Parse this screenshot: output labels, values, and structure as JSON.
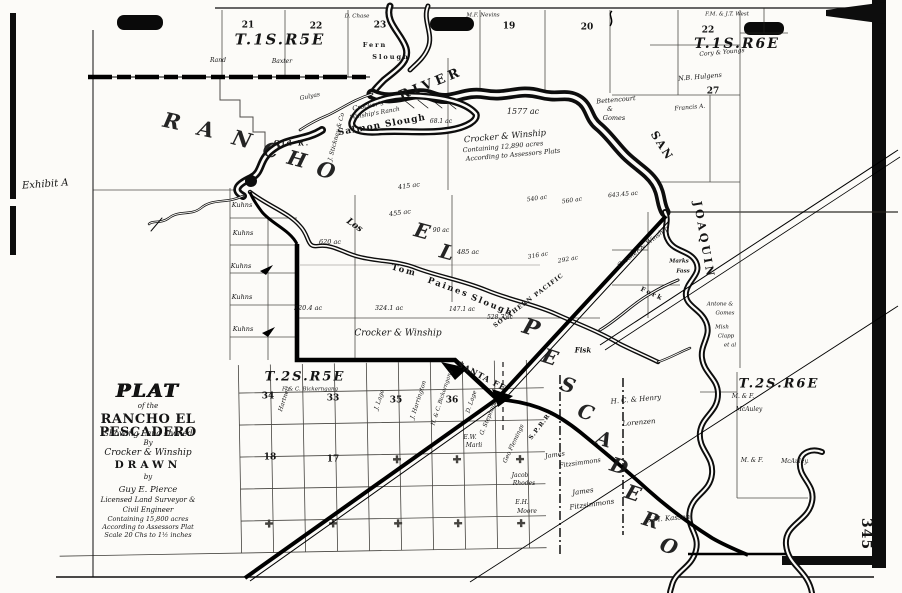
{
  "document": {
    "exhibit_label": "Exhibit A",
    "page_number": "345"
  },
  "title_block": {
    "lines": [
      "PLAT",
      "of the",
      "RANCHO EL PESCADERO",
      "Showing Land Owned",
      "By",
      "Crocker & Winship",
      "DRAWN",
      "by",
      "Guy E. Pierce",
      "Licensed Land Surveyor &",
      "Civil Engineer",
      "Containing 15,800 acres",
      "According to Assessors Plat",
      "Scale 20 Chs to 1½ inches"
    ]
  },
  "map": {
    "township_labels": [
      {
        "t": "T.1S.R5E",
        "x": 280,
        "y": 40,
        "r": 0,
        "s": 15
      },
      {
        "t": "T.1S.R6E",
        "x": 737,
        "y": 44,
        "r": 0,
        "s": 14
      },
      {
        "t": "T.2S.R5E",
        "x": 305,
        "y": 377,
        "r": 0,
        "s": 13
      },
      {
        "t": "T.2S.R6E",
        "x": 779,
        "y": 384,
        "r": 0,
        "s": 13
      }
    ],
    "section_numbers": [
      {
        "t": "21",
        "x": 248,
        "y": 26,
        "r": 0,
        "s": 9
      },
      {
        "t": "22",
        "x": 316,
        "y": 27,
        "r": 0,
        "s": 9
      },
      {
        "t": "23",
        "x": 380,
        "y": 26,
        "r": 0,
        "s": 9
      },
      {
        "t": "19",
        "x": 509,
        "y": 27,
        "r": 0,
        "s": 9
      },
      {
        "t": "20",
        "x": 587,
        "y": 28,
        "r": 0,
        "s": 9
      },
      {
        "t": "22",
        "x": 708,
        "y": 31,
        "r": 0,
        "s": 9
      },
      {
        "t": "27",
        "x": 713,
        "y": 92,
        "r": 0,
        "s": 9
      },
      {
        "t": "34",
        "x": 268,
        "y": 397,
        "r": 0,
        "s": 9
      },
      {
        "t": "33",
        "x": 333,
        "y": 399,
        "r": 0,
        "s": 9
      },
      {
        "t": "35",
        "x": 396,
        "y": 401,
        "r": 0,
        "s": 9
      },
      {
        "t": "36",
        "x": 452,
        "y": 401,
        "r": 0,
        "s": 9
      },
      {
        "t": "18",
        "x": 270,
        "y": 458,
        "r": 0,
        "s": 9
      },
      {
        "t": "17",
        "x": 333,
        "y": 460,
        "r": 0,
        "s": 9
      }
    ],
    "rancho_name_letters": [
      {
        "t": "R",
        "x": 172,
        "y": 121,
        "r": 12,
        "s": 21
      },
      {
        "t": "A",
        "x": 206,
        "y": 129,
        "r": 12,
        "s": 21
      },
      {
        "t": "N",
        "x": 242,
        "y": 139,
        "r": 15,
        "s": 21
      },
      {
        "t": "C",
        "x": 271,
        "y": 150,
        "r": 15,
        "s": 20
      },
      {
        "t": "H",
        "x": 297,
        "y": 159,
        "r": 15,
        "s": 20
      },
      {
        "t": "O",
        "x": 326,
        "y": 170,
        "r": 15,
        "s": 21
      },
      {
        "t": "E",
        "x": 422,
        "y": 231,
        "r": 15,
        "s": 20
      },
      {
        "t": "L",
        "x": 447,
        "y": 252,
        "r": 15,
        "s": 20
      },
      {
        "t": "P",
        "x": 531,
        "y": 328,
        "r": 18,
        "s": 22
      },
      {
        "t": "E",
        "x": 550,
        "y": 357,
        "r": 18,
        "s": 20
      },
      {
        "t": "S",
        "x": 568,
        "y": 385,
        "r": 18,
        "s": 20
      },
      {
        "t": "C",
        "x": 586,
        "y": 412,
        "r": 18,
        "s": 20
      },
      {
        "t": "A",
        "x": 604,
        "y": 439,
        "r": 18,
        "s": 20
      },
      {
        "t": "D",
        "x": 619,
        "y": 466,
        "r": 18,
        "s": 20
      },
      {
        "t": "E",
        "x": 633,
        "y": 493,
        "r": 18,
        "s": 20
      },
      {
        "t": "R",
        "x": 651,
        "y": 520,
        "r": 18,
        "s": 20
      },
      {
        "t": "O",
        "x": 669,
        "y": 546,
        "r": 18,
        "s": 20
      }
    ],
    "water_labels": [
      {
        "t": "RIVER",
        "x": 431,
        "y": 84,
        "r": -22,
        "s": 13,
        "ls": 4
      },
      {
        "t": "SAN",
        "x": 662,
        "y": 146,
        "r": 58,
        "s": 11,
        "ls": 2
      },
      {
        "t": "JOAQUIN",
        "x": 704,
        "y": 240,
        "r": 80,
        "s": 11,
        "ls": 3
      },
      {
        "t": "Salmon Slough",
        "x": 382,
        "y": 126,
        "r": -10,
        "s": 9,
        "ls": 1
      },
      {
        "t": "Tom",
        "x": 404,
        "y": 271,
        "r": 15,
        "s": 8.5
      },
      {
        "t": "Paines",
        "x": 448,
        "y": 288,
        "r": 20,
        "s": 8.5
      },
      {
        "t": "Slough",
        "x": 492,
        "y": 306,
        "r": 22,
        "s": 8.5
      },
      {
        "t": "Old R.",
        "x": 292,
        "y": 143,
        "r": 0,
        "s": 7
      },
      {
        "t": "Fern",
        "x": 375,
        "y": 45,
        "r": 0,
        "s": 6.5
      },
      {
        "t": "Slough",
        "x": 391,
        "y": 57,
        "r": 0,
        "s": 6.5
      },
      {
        "t": "Fork",
        "x": 652,
        "y": 294,
        "r": 25,
        "s": 6.5
      }
    ],
    "place_labels": [
      {
        "t": "Los",
        "x": 354,
        "y": 226,
        "r": 35,
        "s": 9
      },
      {
        "t": "Fisk",
        "x": 583,
        "y": 350,
        "r": 0,
        "s": 7
      },
      {
        "t": "Marks",
        "x": 679,
        "y": 262,
        "r": 0,
        "s": 5.5
      },
      {
        "t": "Fass",
        "x": 683,
        "y": 272,
        "r": 0,
        "s": 5.5
      }
    ],
    "railroad_labels": [
      {
        "t": "SOUTHERN PACIFIC",
        "x": 529,
        "y": 301,
        "r": -37,
        "s": 6,
        "ls": 1
      },
      {
        "t": "S.P.R.R.",
        "x": 541,
        "y": 426,
        "r": -52,
        "s": 6
      },
      {
        "t": "SANTA FE",
        "x": 482,
        "y": 376,
        "r": 28,
        "s": 8,
        "ls": 1
      }
    ],
    "owner_labels": [
      {
        "t": "Crocker & Winship",
        "x": 505,
        "y": 137,
        "r": -5,
        "s": 8.5
      },
      {
        "t": "Containing 12,890 acres",
        "x": 503,
        "y": 147,
        "r": -5,
        "s": 6.5
      },
      {
        "t": "According to Assessors Plats",
        "x": 513,
        "y": 155,
        "r": -5,
        "s": 6.5
      },
      {
        "t": "Crocker's",
        "x": 368,
        "y": 106,
        "r": -10,
        "s": 6.5
      },
      {
        "t": "Winship's Ranch",
        "x": 375,
        "y": 114,
        "r": -10,
        "s": 6
      },
      {
        "t": "Crocker & Winship",
        "x": 398,
        "y": 334,
        "r": 0,
        "s": 9
      },
      {
        "t": "Crocker & Winship",
        "x": 643,
        "y": 247,
        "r": -38,
        "s": 6.5
      },
      {
        "t": "Bettencourt",
        "x": 616,
        "y": 100,
        "r": -5,
        "s": 6.5
      },
      {
        "t": "&",
        "x": 610,
        "y": 109,
        "r": 0,
        "s": 6.5
      },
      {
        "t": "Gomes",
        "x": 614,
        "y": 118,
        "r": 0,
        "s": 6.5
      },
      {
        "t": "Rand",
        "x": 218,
        "y": 61,
        "r": 0,
        "s": 6
      },
      {
        "t": "Baxter",
        "x": 282,
        "y": 62,
        "r": 0,
        "s": 6
      },
      {
        "t": "D. Chase",
        "x": 357,
        "y": 17,
        "r": 0,
        "s": 5.5
      },
      {
        "t": "M.F. Nevins",
        "x": 483,
        "y": 16,
        "r": 0,
        "s": 5.5
      },
      {
        "t": "F.M. & J.T. West",
        "x": 727,
        "y": 15,
        "r": 0,
        "s": 5.5
      },
      {
        "t": "Cory & Youngs",
        "x": 722,
        "y": 53,
        "r": -5,
        "s": 6
      },
      {
        "t": "N.B. Hulgens",
        "x": 700,
        "y": 77,
        "r": -5,
        "s": 6.5
      },
      {
        "t": "Francis A.",
        "x": 690,
        "y": 108,
        "r": -5,
        "s": 6
      },
      {
        "t": "Gulyas",
        "x": 310,
        "y": 97,
        "r": -12,
        "s": 6
      },
      {
        "t": "J. Stickney & Co",
        "x": 337,
        "y": 137,
        "r": -75,
        "s": 6
      },
      {
        "t": "Kuhns",
        "x": 242,
        "y": 205,
        "r": 0,
        "s": 6.5
      },
      {
        "t": "Kuhns",
        "x": 243,
        "y": 233,
        "r": 0,
        "s": 6.5
      },
      {
        "t": "Kuhns",
        "x": 241,
        "y": 266,
        "r": 0,
        "s": 6.5
      },
      {
        "t": "Kuhns",
        "x": 242,
        "y": 297,
        "r": 0,
        "s": 6.5
      },
      {
        "t": "Kuhns",
        "x": 243,
        "y": 329,
        "r": 0,
        "s": 6.5
      },
      {
        "t": "F. & C. Bickerngang",
        "x": 310,
        "y": 390,
        "r": 0,
        "s": 5.5
      },
      {
        "t": "Hartnett",
        "x": 285,
        "y": 399,
        "r": -72,
        "s": 6
      },
      {
        "t": "J. Lage",
        "x": 380,
        "y": 400,
        "r": -72,
        "s": 6
      },
      {
        "t": "J. Harrington",
        "x": 419,
        "y": 400,
        "r": -72,
        "s": 6
      },
      {
        "t": "H. & C. Bickerngang",
        "x": 443,
        "y": 398,
        "r": -72,
        "s": 5.5
      },
      {
        "t": "D. Lage",
        "x": 472,
        "y": 402,
        "r": -72,
        "s": 6
      },
      {
        "t": "G. Stephens",
        "x": 489,
        "y": 418,
        "r": -68,
        "s": 6
      },
      {
        "t": "Geo Flemings",
        "x": 514,
        "y": 444,
        "r": -65,
        "s": 6
      },
      {
        "t": "James",
        "x": 555,
        "y": 455,
        "r": -8,
        "s": 6.5
      },
      {
        "t": "Fitzsimmons",
        "x": 580,
        "y": 463,
        "r": -8,
        "s": 6.5
      },
      {
        "t": "James",
        "x": 583,
        "y": 492,
        "r": -8,
        "s": 7
      },
      {
        "t": "Fitzsimmons",
        "x": 592,
        "y": 505,
        "r": -8,
        "s": 7
      },
      {
        "t": "Jacob",
        "x": 520,
        "y": 476,
        "r": 0,
        "s": 6
      },
      {
        "t": "Rhodes",
        "x": 524,
        "y": 484,
        "r": 0,
        "s": 6
      },
      {
        "t": "E.H.",
        "x": 522,
        "y": 503,
        "r": 0,
        "s": 6
      },
      {
        "t": "Moore",
        "x": 527,
        "y": 512,
        "r": 0,
        "s": 6
      },
      {
        "t": "E.W.",
        "x": 470,
        "y": 438,
        "r": 0,
        "s": 6
      },
      {
        "t": "Marli",
        "x": 474,
        "y": 446,
        "r": 0,
        "s": 6
      },
      {
        "t": "G.M. Kasson",
        "x": 668,
        "y": 519,
        "r": -5,
        "s": 7
      },
      {
        "t": "H. C. & Henry",
        "x": 636,
        "y": 400,
        "r": -5,
        "s": 7
      },
      {
        "t": "Lorenzen",
        "x": 639,
        "y": 423,
        "r": -5,
        "s": 7
      },
      {
        "t": "M. & F.",
        "x": 743,
        "y": 397,
        "r": 0,
        "s": 6
      },
      {
        "t": "McAuley",
        "x": 749,
        "y": 410,
        "r": 0,
        "s": 6
      },
      {
        "t": "M. & F.",
        "x": 752,
        "y": 461,
        "r": 0,
        "s": 6
      },
      {
        "t": "McAuley.",
        "x": 795,
        "y": 462,
        "r": 0,
        "s": 6
      },
      {
        "t": "Antone &",
        "x": 720,
        "y": 305,
        "r": 0,
        "s": 5.5
      },
      {
        "t": "Gomes",
        "x": 725,
        "y": 314,
        "r": 0,
        "s": 5.5
      },
      {
        "t": "Mish",
        "x": 722,
        "y": 328,
        "r": 0,
        "s": 5.5
      },
      {
        "t": "Clapp",
        "x": 726,
        "y": 337,
        "r": 0,
        "s": 5.5
      },
      {
        "t": "et al",
        "x": 730,
        "y": 346,
        "r": 0,
        "s": 5.5
      }
    ],
    "acreage_labels": [
      {
        "t": "1577 ac",
        "x": 523,
        "y": 112,
        "r": 0,
        "s": 8
      },
      {
        "t": "68.1 ac",
        "x": 441,
        "y": 122,
        "r": 0,
        "s": 6
      },
      {
        "t": "415 ac",
        "x": 409,
        "y": 186,
        "r": -8,
        "s": 6.5
      },
      {
        "t": "455 ac",
        "x": 400,
        "y": 213,
        "r": -8,
        "s": 6.5
      },
      {
        "t": "90 ac",
        "x": 441,
        "y": 231,
        "r": 0,
        "s": 6
      },
      {
        "t": "485 ac",
        "x": 468,
        "y": 252,
        "r": 0,
        "s": 6.5
      },
      {
        "t": "620 ac",
        "x": 330,
        "y": 242,
        "r": 0,
        "s": 6.5
      },
      {
        "t": "320.4 ac",
        "x": 308,
        "y": 308,
        "r": 0,
        "s": 6.5
      },
      {
        "t": "324.1 ac",
        "x": 389,
        "y": 308,
        "r": 0,
        "s": 6.5
      },
      {
        "t": "147.1 ac",
        "x": 462,
        "y": 310,
        "r": 0,
        "s": 6
      },
      {
        "t": "528.7 ac",
        "x": 500,
        "y": 318,
        "r": 0,
        "s": 6
      },
      {
        "t": "316 ac",
        "x": 538,
        "y": 256,
        "r": -10,
        "s": 6
      },
      {
        "t": "292 ac",
        "x": 568,
        "y": 260,
        "r": -10,
        "s": 6
      },
      {
        "t": "540 ac",
        "x": 537,
        "y": 199,
        "r": -8,
        "s": 6
      },
      {
        "t": "560 ac",
        "x": 572,
        "y": 201,
        "r": -8,
        "s": 6
      },
      {
        "t": "643.45 ac",
        "x": 623,
        "y": 195,
        "r": -5,
        "s": 6
      }
    ]
  }
}
